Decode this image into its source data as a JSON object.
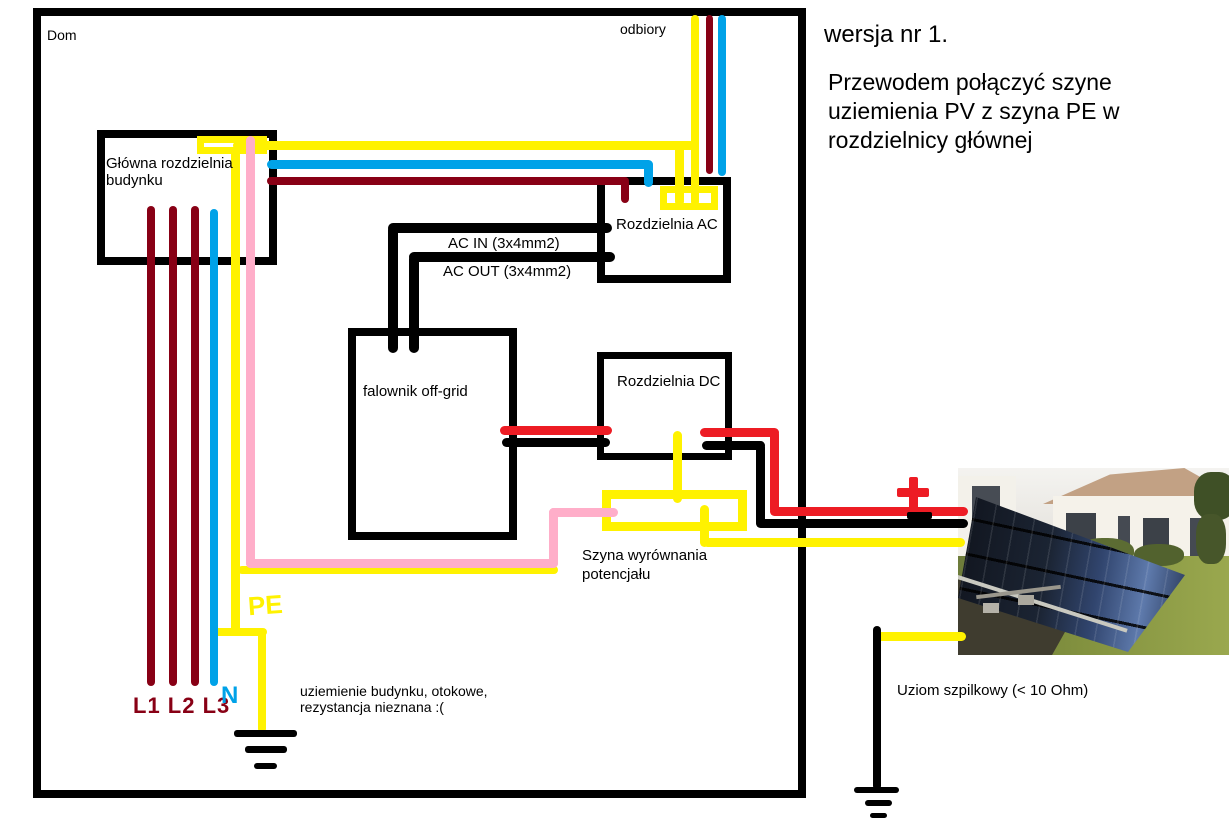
{
  "header": {
    "version_label": "wersja nr 1.",
    "instruction": "Przewodem połączyć szyne\nuziemienia PV z szyna PE w\nrozdzielnicy głównej"
  },
  "labels": {
    "house": "Dom",
    "loads": "odbiory",
    "main_board": "Główna rozdzielnia\nbudynku",
    "ac_board": "Rozdzielnia AC",
    "dc_board": "Rozdzielnia DC",
    "inverter": "falownik off-grid",
    "ac_in": "AC IN (3x4mm2)",
    "ac_out": "AC OUT (3x4mm2)",
    "equipotential_bus": "Szyna wyrównania\npotencjału",
    "building_earth": "uziemienie budynku, otokowe,\nrezystancja nieznana :(",
    "earth_rod": "Uziom szpilkowy (< 10 Ohm)",
    "phases": "L1 L2 L3",
    "neutral": "N",
    "protective_earth": "PE"
  },
  "symbols": {
    "plus": "+",
    "minus": "−",
    "ground_left": "earth-ground-symbol",
    "ground_right": "earth-ground-symbol"
  },
  "colors": {
    "phase_wire": "#880015",
    "neutral_wire": "#00a2e8",
    "pe_wire": "#fff200",
    "pv_plus_wire": "#ed1c24",
    "pv_minus_wire": "#000000",
    "bonding_wire": "#ffaec9",
    "outline": "#000000",
    "background": "#ffffff"
  }
}
